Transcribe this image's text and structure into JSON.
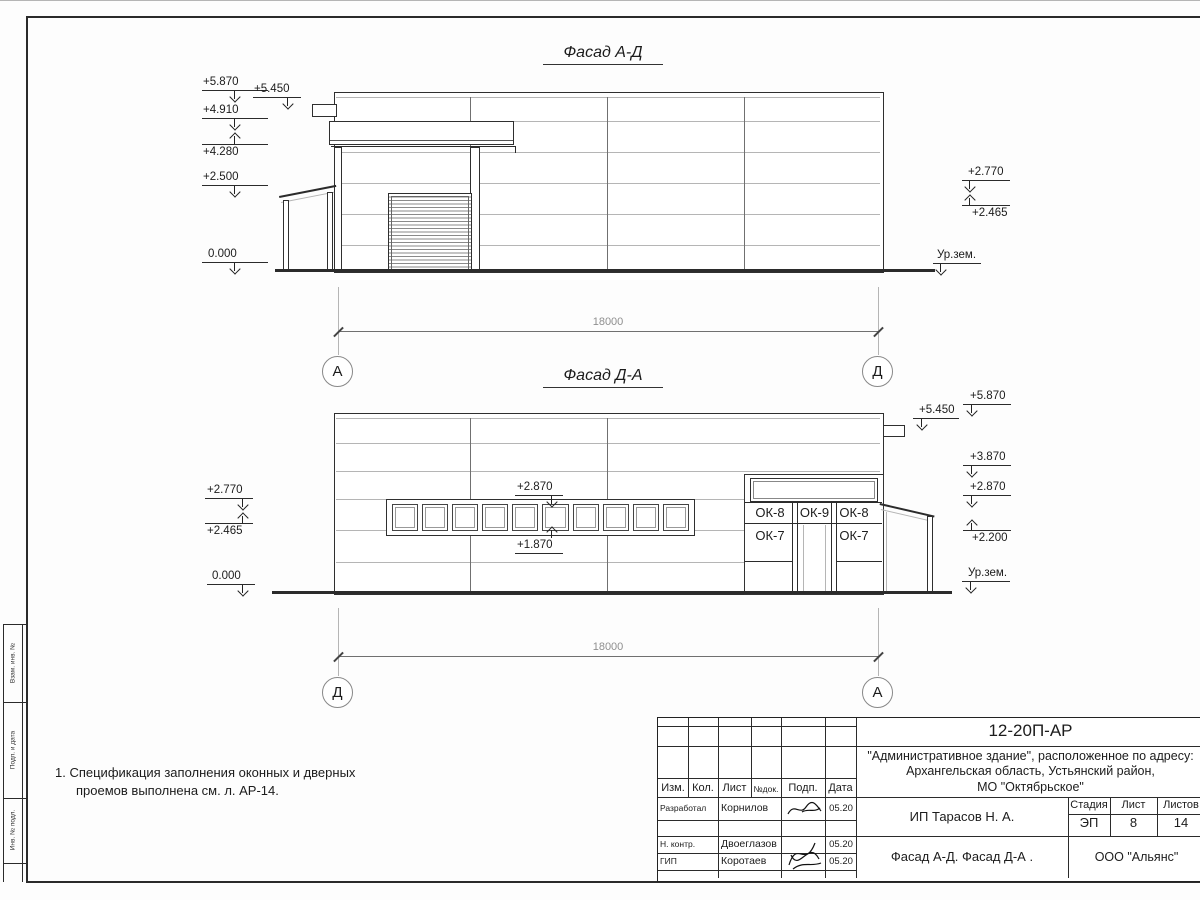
{
  "sheet": {
    "facade1": {
      "title": "Фасад А-Д",
      "axis_left": "А",
      "axis_right": "Д",
      "dim": "18000",
      "l5870": "+5.870",
      "l4910": "+4.910",
      "l4280": "+4.280",
      "l2500": "+2.500",
      "l0000": "0.000",
      "l5450": "+5.450",
      "r2770": "+2.770",
      "r2465": "+2.465",
      "ground": "Ур.зем."
    },
    "facade2": {
      "title": "Фасад Д-А",
      "axis_left": "Д",
      "axis_right": "А",
      "dim": "18000",
      "l2770": "+2.770",
      "l2465": "+2.465",
      "l0000": "0.000",
      "r5870": "+5.870",
      "r5450": "+5.450",
      "r3870": "+3.870",
      "r2870": "+2.870",
      "r2200": "+2.200",
      "ground": "Ур.зем.",
      "band_top": "+2.870",
      "band_bottom": "+1.870",
      "ok8": "ОК-8",
      "ok9": "ОК-9",
      "ok7": "ОК-7"
    },
    "note1": "1. Спецификация заполнения оконных и дверных",
    "note2": "проемов выполнена см. л. АР-14."
  },
  "strip": {
    "c1": "Взам. инв. №",
    "c2": "Подп. и дата",
    "c3": "Инв. № подл."
  },
  "stamp": {
    "doc": "12-20П-АР",
    "addr1": "\"Административное здание\", расположенное по адресу:",
    "addr2": "Архангельская область, Устьянский район,",
    "addr3": "МО \"Октябрьское\"",
    "client": "ИП Тарасов Н. А.",
    "title": "Фасад А-Д. Фасад Д-А .",
    "org": "ООО \"Альянс\"",
    "h_izm": "Изм.",
    "h_kol": "Кол.",
    "h_list": "Лист",
    "h_doc": "№док.",
    "h_podp": "Подп.",
    "h_data": "Дата",
    "stage_l": "Стадия",
    "sheet_l": "Лист",
    "sheets_l": "Листов",
    "stage": "ЭП",
    "sheet_n": "8",
    "sheets_n": "14",
    "r1_role": "Разработал",
    "r1_name": "Корнилов",
    "r1_date": "05.20",
    "r2_role": "Н. контр.",
    "r2_name": "Двоеглазов",
    "r2_date": "05.20",
    "r3_role": "ГИП",
    "r3_name": "Коротаев",
    "r3_date": "05.20"
  }
}
